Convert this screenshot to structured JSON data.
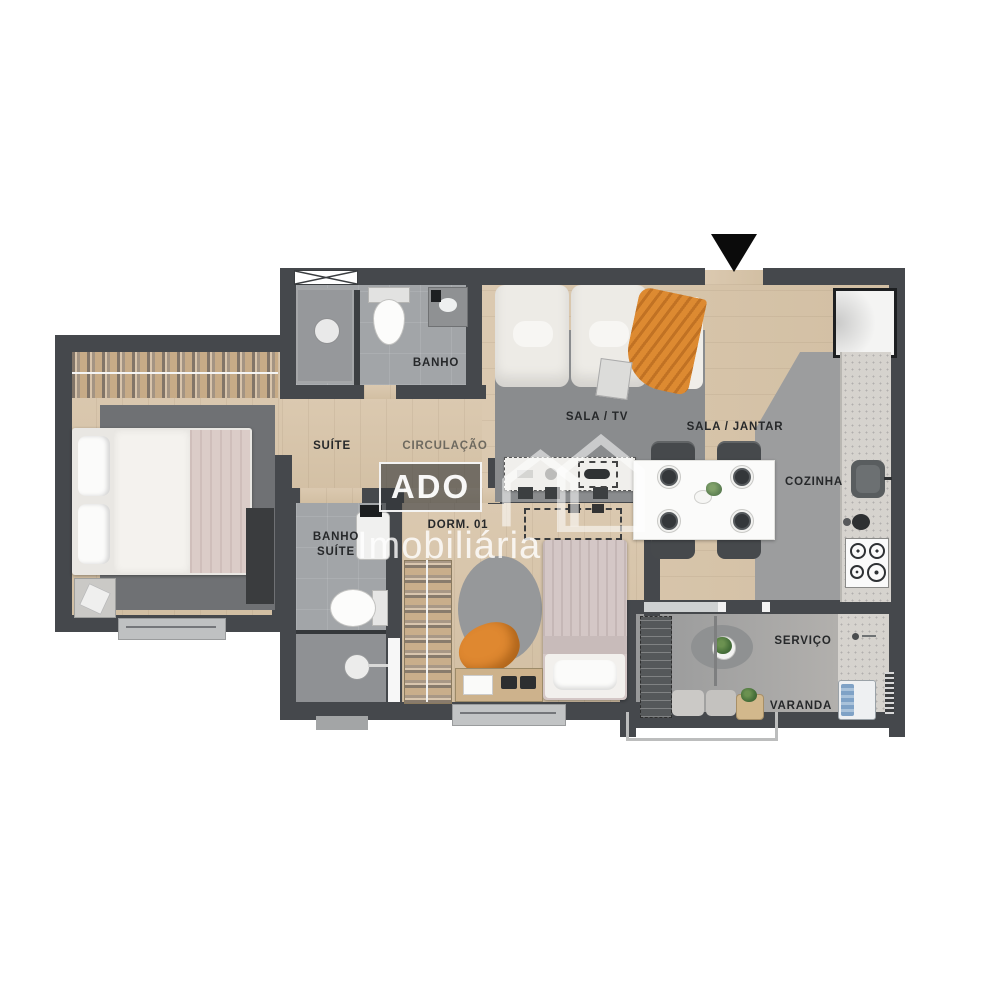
{
  "watermark": {
    "brand": "ADO",
    "subtitle": "Imobiliária"
  },
  "rooms": {
    "suite": {
      "label": "SUÍTE"
    },
    "banho": {
      "label": "BANHO"
    },
    "circulacao": {
      "label": "CIRCULAÇÃO"
    },
    "sala_tv": {
      "label": "SALA / TV"
    },
    "sala_jantar": {
      "label": "SALA / JANTAR"
    },
    "cozinha": {
      "label": "COZINHA"
    },
    "banho_suite": {
      "line1": "BANHO",
      "line2": "SUÍTE"
    },
    "dorm01": {
      "label": "DORM. 01"
    },
    "servico": {
      "label": "SERVIÇO"
    },
    "varanda": {
      "label": "VARANDA"
    }
  },
  "icons": {
    "entrance": "triangle-down-entrance-marker",
    "logo": "house-outline"
  },
  "colors": {
    "wall": "#45484c",
    "wood_floor": "#d7c4aa",
    "tile_floor": "#a2a5a8",
    "rug_gray": "#8b8d8f",
    "accent_orange": "#dd8a31",
    "washer_blue": "#7fa2c6",
    "plant_green": "#47703a",
    "label_text": "#26282a"
  }
}
